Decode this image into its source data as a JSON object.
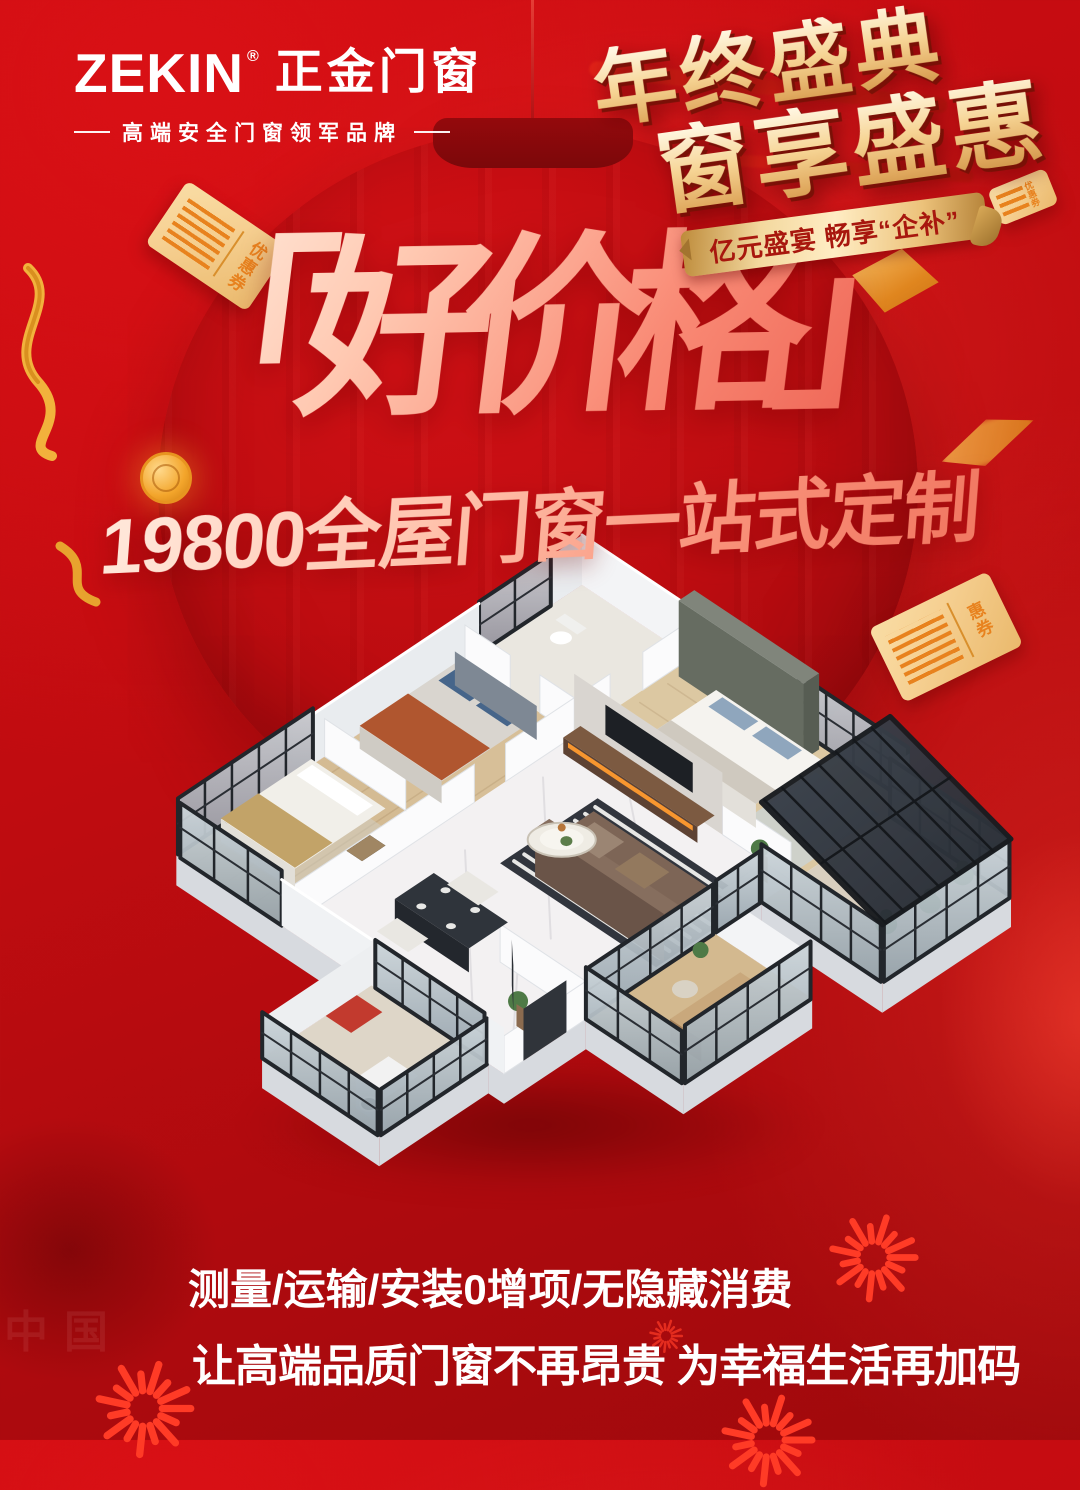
{
  "poster": {
    "brand": {
      "name_en": "ZEKIN",
      "registered_mark": "®",
      "name_cn": "正金门窗",
      "tagline": "高端安全门窗领军品牌"
    },
    "festival": {
      "title_line1": "年终盛典",
      "title_line2": "窗享盛惠",
      "ribbon_text": "亿元盛宴 畅享“企补”"
    },
    "headline": {
      "price_title": "「好价格」",
      "offer_line": "19800全屋门窗一站式定制"
    },
    "footer": {
      "line1": "测量/运输/安装0增项/无隐藏消费",
      "line2": "让高端品质门窗不再昂贵 为幸福生活再加码"
    },
    "coupons": {
      "left_label": "优惠券",
      "right_label": "惠券",
      "top_right_label": "优惠券"
    },
    "watermark": "中国",
    "colors": {
      "background_red": "#c30d11",
      "gold": "#f6d494",
      "headline_pink": "#ffc9b2",
      "coupon_orange": "#e8821e",
      "firework_red": "#ff3b26",
      "text_white": "#ffffff"
    }
  }
}
